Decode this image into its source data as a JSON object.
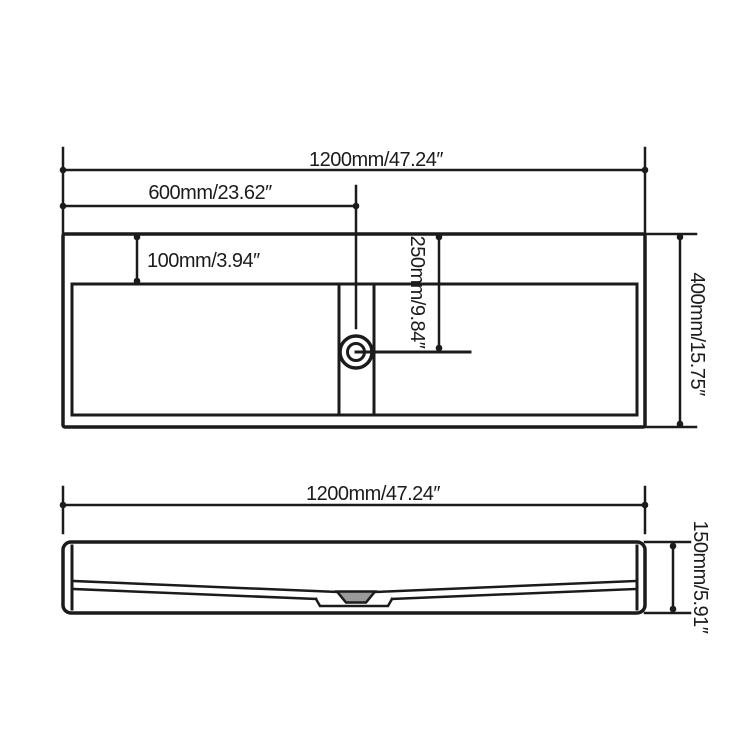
{
  "top_view": {
    "overall_width": "1200mm/47.24″",
    "drain_offset_x": "600mm/23.62″",
    "deck_depth": "100mm/3.94″",
    "drain_offset_y": "250mm/9.84″",
    "overall_depth": "400mm/15.75″"
  },
  "front_view": {
    "overall_width": "1200mm/47.24″",
    "overall_height": "150mm/5.91″"
  },
  "colors": {
    "line": "#1b1b1b",
    "background": "#ffffff",
    "drain_fill": "#9a9a9a"
  }
}
